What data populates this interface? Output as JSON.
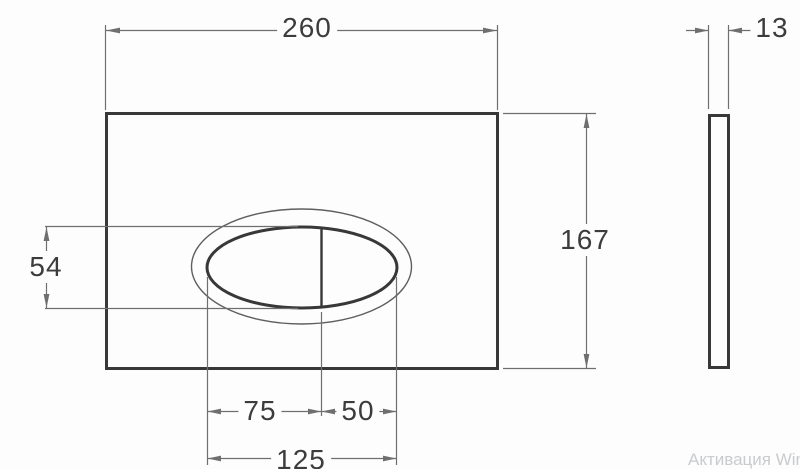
{
  "drawing": {
    "title": "flush plate dimensioned drawing",
    "front_view": {
      "plate_width_mm": "260",
      "plate_height_mm": "167",
      "oval_height_mm": "54",
      "left_button_width_mm": "75",
      "right_button_width_mm": "50",
      "oval_total_width_mm": "125"
    },
    "side_view": {
      "plate_thickness_mm": "13"
    },
    "colors": {
      "outline": "#383838",
      "thin_line": "#6f6f6f",
      "outer_oval_line": "#5f5f5f",
      "background": "#fdfdfd",
      "label_text": "#3c3c3c",
      "watermark_text": "#c9cbcd"
    }
  },
  "watermark": {
    "text": "Активация Windo"
  }
}
